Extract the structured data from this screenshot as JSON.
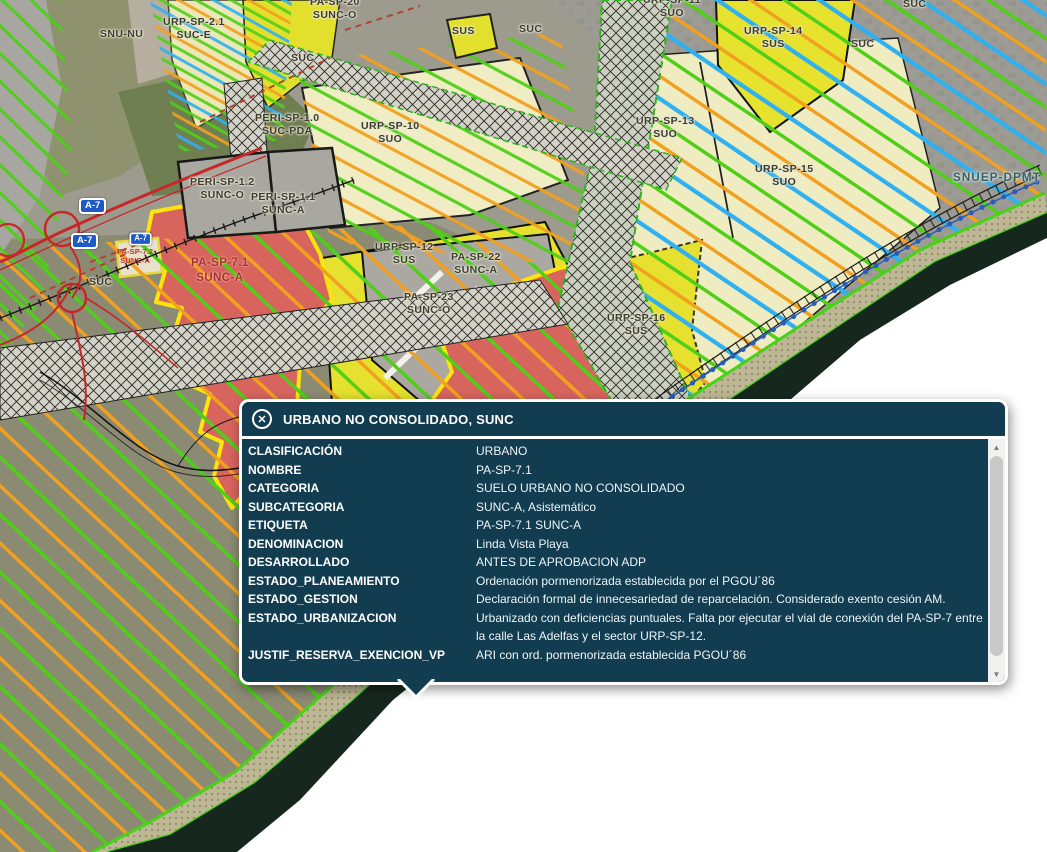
{
  "popup": {
    "title": "URBANO NO CONSOLIDADO, SUNC",
    "close_glyph": "✕",
    "scrollbar": {
      "up_glyph": "▲",
      "down_glyph": "▼"
    },
    "rows": [
      {
        "label": "CLASIFICACIÓN",
        "value": "URBANO"
      },
      {
        "label": "NOMBRE",
        "value": "PA-SP-7.1"
      },
      {
        "label": "CATEGORIA",
        "value": "SUELO URBANO NO CONSOLIDADO"
      },
      {
        "label": "SUBCATEGORIA",
        "value": "SUNC-A, Asistemático"
      },
      {
        "label": "ETIQUETA",
        "value": "PA-SP-7.1 SUNC-A"
      },
      {
        "label": "DENOMINACION",
        "value": "Linda Vista Playa"
      },
      {
        "label": "DESARROLLADO",
        "value": "ANTES DE APROBACION ADP"
      },
      {
        "label": "ESTADO_PLANEAMIENTO",
        "value": "Ordenación pormenorizada establecida por el PGOU´86"
      },
      {
        "label": "ESTADO_GESTION",
        "value": "Declaración formal de innecesariedad de reparcelación. Considerado exento cesión AM."
      },
      {
        "label": "ESTADO_URBANIZACION",
        "value": "Urbanizado con deficiencias puntuales. Falta por ejecutar el vial de conexión del PA-SP-7 entre la calle Las Adelfas y el sector URP-SP-12."
      },
      {
        "label": "JUSTIF_RESERVA_EXENCION_VP",
        "value": "ARI con ord. pormenorizada establecida PGOU´86"
      }
    ]
  },
  "map": {
    "labels": [
      {
        "text": "SNU-NU",
        "x": 100,
        "y": 28,
        "style": "dark"
      },
      {
        "text": "URP-SP-2.1\nSUC-E",
        "x": 163,
        "y": 16,
        "style": "dark"
      },
      {
        "text": "PA-SP-20\nSUNC-O",
        "x": 310,
        "y": -4,
        "style": "dark"
      },
      {
        "text": "SUS",
        "x": 452,
        "y": 25,
        "style": "dark"
      },
      {
        "text": "SUC",
        "x": 519,
        "y": 23,
        "style": "dark"
      },
      {
        "text": "URP-SP-11\nSUO",
        "x": 643,
        "y": -6,
        "style": "dark"
      },
      {
        "text": "SUC",
        "x": 903,
        "y": -2,
        "style": "dark"
      },
      {
        "text": "URP-SP-14\nSUS",
        "x": 744,
        "y": 25,
        "style": "dark"
      },
      {
        "text": "SUC",
        "x": 851,
        "y": 38,
        "style": "dark"
      },
      {
        "text": "SUC",
        "x": 291,
        "y": 52,
        "style": "dark"
      },
      {
        "text": "PERI-SP-1.0\nSUC-PDA",
        "x": 255,
        "y": 112,
        "style": "dark"
      },
      {
        "text": "URP-SP-10\nSUO",
        "x": 361,
        "y": 120,
        "style": "dark"
      },
      {
        "text": "URP-SP-13\nSUO",
        "x": 636,
        "y": 115,
        "style": "dark"
      },
      {
        "text": "URP-SP-15\nSUO",
        "x": 755,
        "y": 163,
        "style": "dark"
      },
      {
        "text": "SNUEP-DPMT",
        "x": 953,
        "y": 172,
        "style": "beach"
      },
      {
        "text": "PERI-SP-1.2\nSUNC-O",
        "x": 190,
        "y": 176,
        "style": "dark"
      },
      {
        "text": "PERI-SP-1.1\nSUNC-A",
        "x": 251,
        "y": 191,
        "style": "dark"
      },
      {
        "text": "A-7",
        "x": 79,
        "y": 198,
        "style": "shield"
      },
      {
        "text": "A-7",
        "x": 71,
        "y": 233,
        "style": "shield"
      },
      {
        "text": "A-7",
        "x": 127,
        "y": 231,
        "style": "shield shield-sm"
      },
      {
        "text": "PA-SP-7.2\nSUNC-A",
        "x": 117,
        "y": 247,
        "style": "tinyred"
      },
      {
        "text": "PA-SP-7.1\nSUNC-A",
        "x": 191,
        "y": 256,
        "style": "red"
      },
      {
        "text": "SUC",
        "x": 89,
        "y": 276,
        "style": "dark"
      },
      {
        "text": "URP-SP-12\nSUS",
        "x": 375,
        "y": 241,
        "style": "dark"
      },
      {
        "text": "PA-SP-22\nSUNC-A",
        "x": 451,
        "y": 251,
        "style": "dark"
      },
      {
        "text": "PA-SP-23\nSUNC-O",
        "x": 404,
        "y": 291,
        "style": "dark"
      },
      {
        "text": "URP-SP-16\nSUS",
        "x": 607,
        "y": 312,
        "style": "dark"
      }
    ]
  }
}
